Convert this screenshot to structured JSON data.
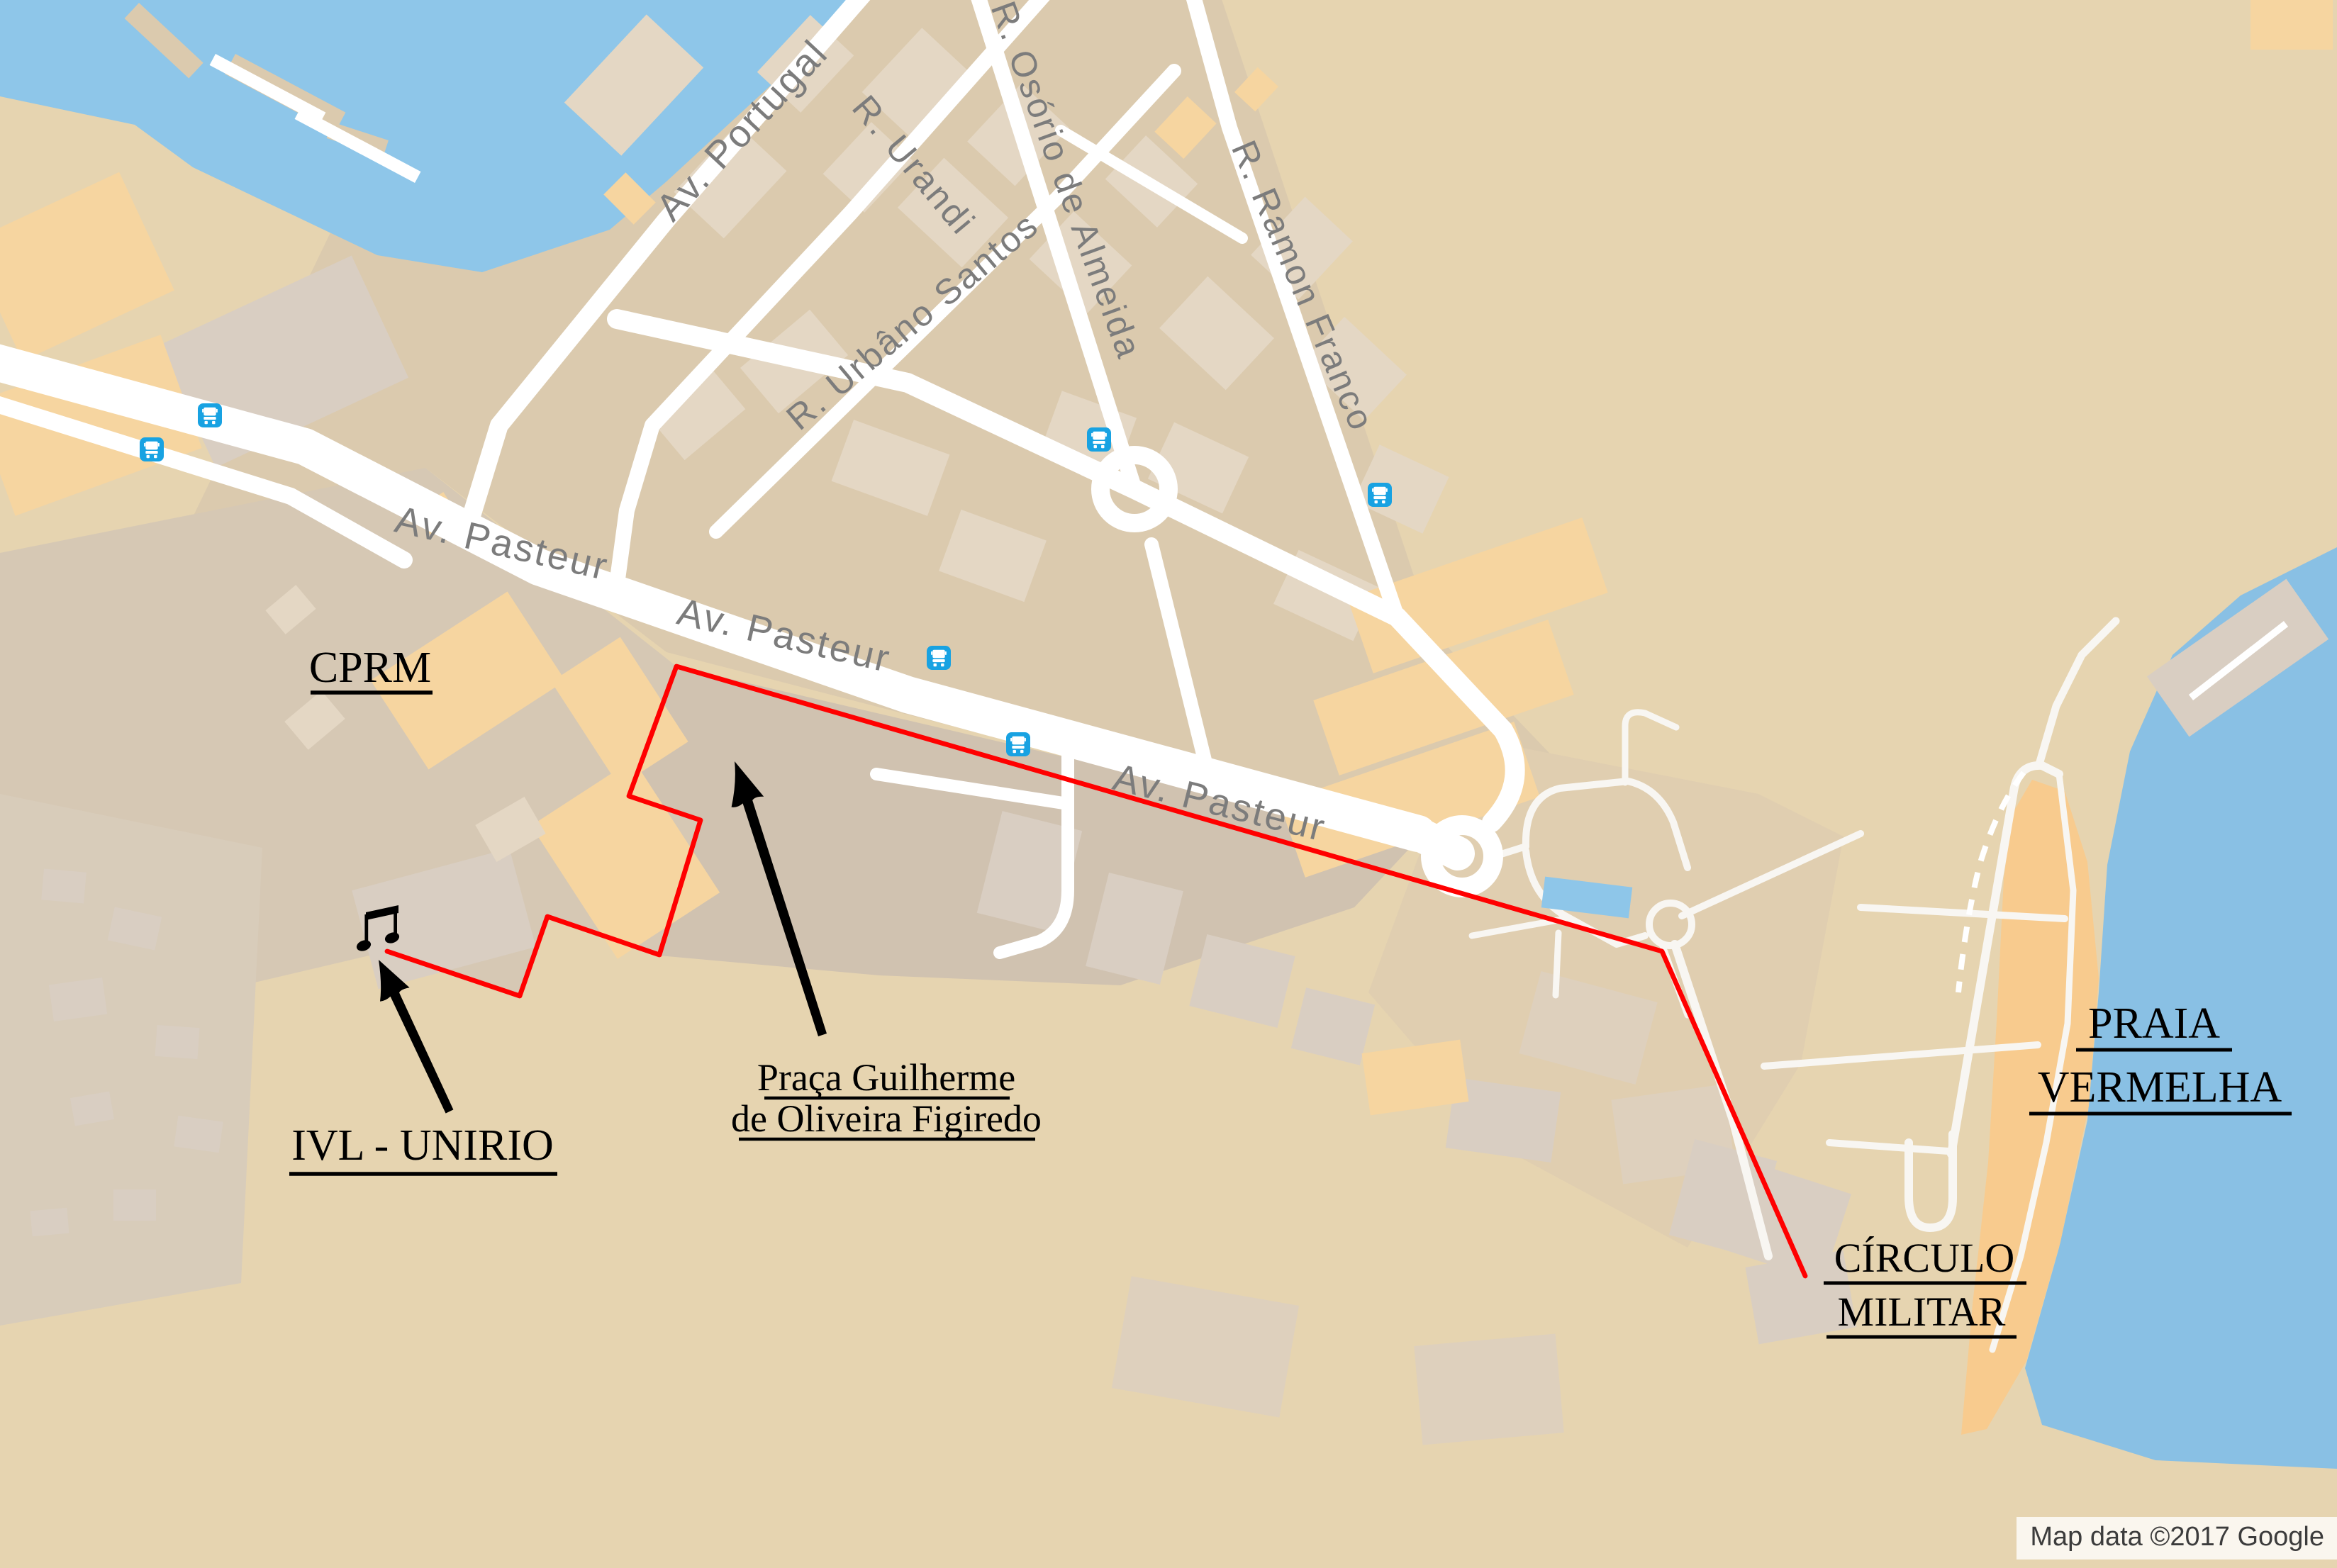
{
  "map": {
    "streets": {
      "portugal": "Av. Portugal",
      "urandi": "R. Urandi",
      "osorio": "R. Osório de Almeida",
      "urbano": "R. Urbâno Santos",
      "ramon": "R. Ramon Franco",
      "pasteur1": "Av. Pasteur",
      "pasteur2": "Av. Pasteur",
      "pasteur3": "Av. Pasteur"
    },
    "annotations": {
      "cprm": "CPRM",
      "ivl": "IVL - UNIRIO",
      "praca1": "Praça Guilherme",
      "praca2": "de Oliveira Figiredo",
      "circulo1": "CÍRCULO",
      "circulo2": "MILITAR",
      "praia1": "PRAIA",
      "praia2": "VERMELHA"
    },
    "attribution": "Map data ©2017 Google",
    "icons": {
      "bus": "bus-stop-icon",
      "note": "music-note-icon",
      "arrow": "hand-drawn-arrow-icon"
    },
    "colors": {
      "water": "#8ec6e9",
      "sea": "#89c0e4",
      "sand": "#e6d4b0",
      "beach": "#f8cb8e",
      "building_orange": "#f6d5a0",
      "road": "#ffffff",
      "route_red": "#ff0000",
      "street_label_gray": "#7c7c7c",
      "annotation_black": "#000000",
      "bus_blue": "#18a2e2"
    }
  }
}
